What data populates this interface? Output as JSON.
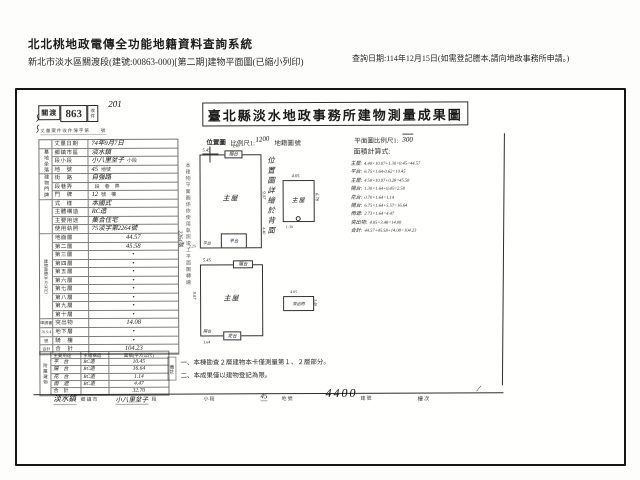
{
  "header": {
    "system_title": "北北桃地政電傳全功能地籍資料查詢系統",
    "subtitle": "新北市淡水區關渡段(建號:00863-000)[第二期]建物平面圖(已縮小列印)",
    "query_date": "查詢日期:114年12月15日(如需登記謄本,請向地政事務所申請。)"
  },
  "doc": {
    "stamp": {
      "office": "關渡",
      "number": "863",
      "side": "收件",
      "hand_note": "201",
      "register_line": "丈量案件收件簿字第　　號",
      "scribble": "〜〜"
    },
    "survey_date": {
      "label": "丈量日期",
      "value": "74年9月7日"
    },
    "title": "臺北縣淡水地政事務所建物測量成果圖",
    "scale_row": {
      "location": "位置圖",
      "scale_label": "比例尺1:",
      "scale_value": "1200",
      "cadastral": "地籍圖",
      "sheet": "號",
      "plan_scale_label": "平面圖比例尺1:",
      "plan_scale_value": "300"
    },
    "location_note": "位置圖詳繪於背面",
    "transcribe_note": "本建物平面圖係依使用執照竣工平面圖轉繪",
    "transcribe_no": "2264號",
    "calc": {
      "label": "面積計算式:",
      "lines": [
        {
          "name": "主屋:",
          "formula": "4.40×10.07+1.30×0.45=44.57"
        },
        {
          "name": "平台:",
          "formula": "6.75×1.64-0.62=10.45"
        },
        {
          "name": "主屋:",
          "formula": "4.50×10.07+0.28=45.58"
        },
        {
          "name": "陽台:",
          "formula": "1.30×1.64+0.45=2.58"
        },
        {
          "name": "花台:",
          "formula": "0.70×1.64=1.14"
        },
        {
          "name": "陽台:",
          "formula": "6.75×1.64+5.57=16.64"
        },
        {
          "name": "雨遮:",
          "formula": "2.73×1.64=4.47"
        },
        {
          "name": "突出物:",
          "formula": "4.05×3.48=14.08"
        },
        {
          "name": "合計:",
          "formula": "44.57+45.58+14.08=104.23"
        }
      ]
    },
    "table": {
      "groups": {
        "site": "基地坐落",
        "address": "建物門牌",
        "area": "建物面積(平方公尺)",
        "annex": "附屬建物"
      },
      "apply": {
        "book": "申請書",
        "date": "76.9.4",
        "no": "號",
        "total": "合計"
      },
      "basic": [
        {
          "label": "鄉鎮市區",
          "value": "淡水鎮",
          "suffix": ""
        },
        {
          "label": "段小段",
          "value": "小八里坌子",
          "suffix": "小段"
        },
        {
          "label": "地　號",
          "value": "45",
          "suffix": "地號"
        },
        {
          "label": "街　路",
          "value": "自強路",
          "suffix": ""
        },
        {
          "label": "段巷弄",
          "value": "",
          "suffix": "段　巷　弄"
        },
        {
          "label": "門　牌",
          "value": "12",
          "suffix": "號　樓"
        },
        {
          "label": "式　樣",
          "value": "本國式",
          "suffix": ""
        },
        {
          "label": "主體構造",
          "value": "RC造",
          "suffix": ""
        },
        {
          "label": "主要用途",
          "value": "集合住宅",
          "suffix": ""
        },
        {
          "label": "使用執照",
          "value": "75淡字第2264號",
          "suffix": ""
        }
      ],
      "floors": [
        {
          "label": "地面層",
          "value": "44.57"
        },
        {
          "label": "第二層",
          "value": "45.58"
        },
        {
          "label": "第三層",
          "value": "•"
        },
        {
          "label": "第四層",
          "value": "•"
        },
        {
          "label": "第五層",
          "value": "•"
        },
        {
          "label": "第六層",
          "value": "•"
        },
        {
          "label": "第七層",
          "value": "•"
        },
        {
          "label": "第八層",
          "value": "•"
        },
        {
          "label": "第九層",
          "value": "•"
        },
        {
          "label": "第十層",
          "value": "•"
        },
        {
          "label": "突出物",
          "value": "14.08"
        },
        {
          "label": "地下層",
          "value": "•"
        },
        {
          "label": "騎　樓",
          "value": "•"
        },
        {
          "label": "合　計",
          "value": "104.23"
        }
      ],
      "annex_header": {
        "use": "主要用途",
        "structure": "主體構造",
        "area": "面積(平方公尺)"
      },
      "annex_rows": [
        {
          "use": "平　台",
          "structure": "RC造",
          "area": "10.45"
        },
        {
          "use": "陽　台",
          "structure": "RC造",
          "area": "16.64"
        },
        {
          "use": "花　台",
          "structure": "RC造",
          "area": "1.14"
        },
        {
          "use": "雨　遮",
          "structure": "RC造",
          "area": "4.47"
        },
        {
          "use": "合　計",
          "structure": "",
          "area": "32.70"
        }
      ]
    },
    "plans": {
      "a": {
        "main": "主屋",
        "top": "陽台",
        "bottom": "平台",
        "corner": "平台",
        "dims": [
          "5.45",
          "1.30",
          "9.07",
          "4.40",
          "2.25"
        ]
      },
      "b": {
        "main": "主屋",
        "dims": [
          "4.05",
          "6.78",
          "1.30"
        ]
      },
      "c": {
        "main": "主屋",
        "top": "陽台",
        "bottom": "花台",
        "corner": "陽台",
        "dims": [
          "5.45",
          "9.07",
          "1.64"
        ]
      },
      "d": {
        "main": "突出物",
        "dims": [
          "4.05",
          "3.48"
        ]
      }
    },
    "notes": {
      "label": "備註",
      "items": [
        "一、本棟勘查２層建物本卡僅測量第１、２層部分。",
        "二、本成果僅以建物登記為限。"
      ]
    },
    "footer_strip": {
      "town_value": "淡水鎮",
      "town_label": "鄉鎮市",
      "sec_value": "小八里坌子",
      "sec_label": "段",
      "subsec_label": "小段",
      "lot_value": "45",
      "lot_label": "地號",
      "bldg_value": "4400",
      "bldg_label": "建號",
      "floor_label": "樓次",
      "slash": "/"
    }
  }
}
